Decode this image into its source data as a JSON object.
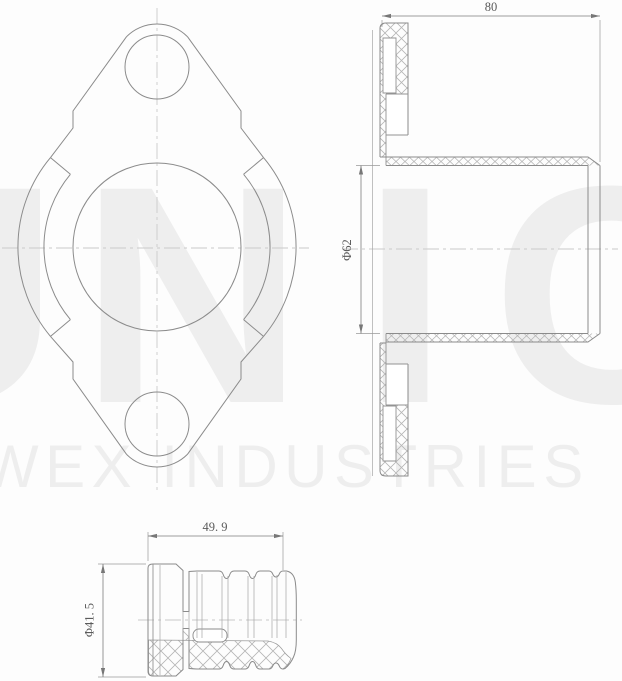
{
  "watermark": {
    "letters": [
      "U",
      "N",
      "I",
      "C"
    ],
    "line2": "WEX INDUSTRIES"
  },
  "dimensions": {
    "flange_overall_width": "80",
    "tube_bore_diameter": "Φ62",
    "bumper_length": "49. 9",
    "bumper_diameter": "Φ41. 5"
  },
  "colors": {
    "background": "#ffffff",
    "outline": "#8b8b8b",
    "centerline": "#c9c9c9",
    "hatch": "#b6b6b6",
    "dimension": "#7d7d7d",
    "watermark": "#eeeeee"
  }
}
